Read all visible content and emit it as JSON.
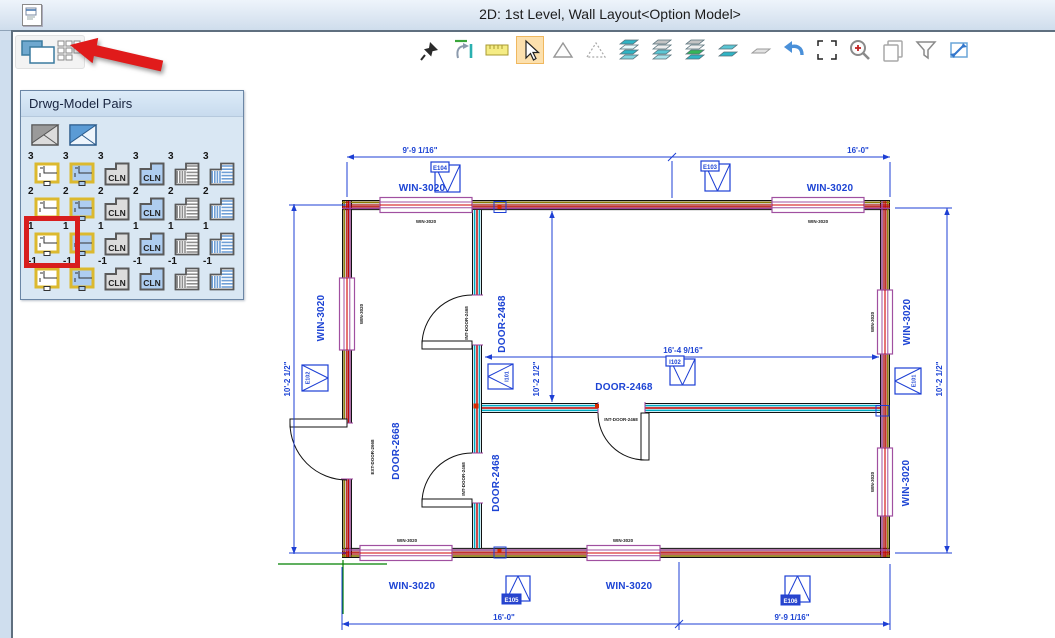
{
  "window": {
    "title": "2D: 1st Level, Wall Layout<Option Model>"
  },
  "mini_toolbar": {
    "icons": [
      "cascade-windows-icon",
      "window-grid-icon"
    ]
  },
  "toolbar": {
    "tools": [
      "pin",
      "fit-extents",
      "measure-ruler",
      "select-cursor",
      "polygon",
      "polygon-dashed",
      "layers-all",
      "layers-top-off",
      "layers-active",
      "layers-pair",
      "layer-single",
      "undo",
      "selection-box",
      "zoom-in",
      "copy-sheets",
      "filter",
      "send-to-window"
    ],
    "active_tool": "select-cursor",
    "highlight_color": "#fce0ad"
  },
  "palette": {
    "title": "Drwg-Model Pairs",
    "header_icons": [
      "corner-model-gray-icon",
      "corner-model-blue-icon"
    ],
    "rows": [
      "3",
      "2",
      "1",
      "-1"
    ],
    "cell_types": [
      "plan-white",
      "plan-blue",
      "cln-gray",
      "cln-blue",
      "stripes-gray",
      "stripes-blue"
    ],
    "cln_label": "CLN",
    "selected_row": "1",
    "selected_type": "plan-white"
  },
  "annotations": {
    "arrow_color": "#e01b1b",
    "highlight_box_color": "#d81e1e"
  },
  "plan": {
    "labels": {
      "window": "WIN-3020",
      "door_int": "DOOR-2468",
      "door_ext": "DOOR-2668",
      "tiny_window": "WIN-3020",
      "tiny_door_int": "INT-DOOR-2468",
      "tiny_door_ext": "EXT-DOOR-2668"
    },
    "markers": {
      "e101": "E101",
      "e102": "E102",
      "e103": "E103",
      "e104": "E104",
      "e105": "E105",
      "e106": "E106",
      "i101": "I101",
      "i102": "I102"
    },
    "dimensions": {
      "d_9_9": "9'-9 1/16\"",
      "d_16_0": "16'-0\"",
      "d_16_4": "16'-4 9/16\"",
      "d_10_2": "10'-2 1/2\""
    },
    "colors": {
      "dim_blue": "#1d3fd4",
      "wall_red": "#c00000",
      "wall_purple": "#9b3f9b",
      "wall_olive": "#8a7a00",
      "wall_fill": "#cfc8bf",
      "interior_cyan": "#00a8c0",
      "interior_fill": "#cdeef5",
      "window_purple": "#a050a0",
      "axis_green": "#008000"
    }
  }
}
